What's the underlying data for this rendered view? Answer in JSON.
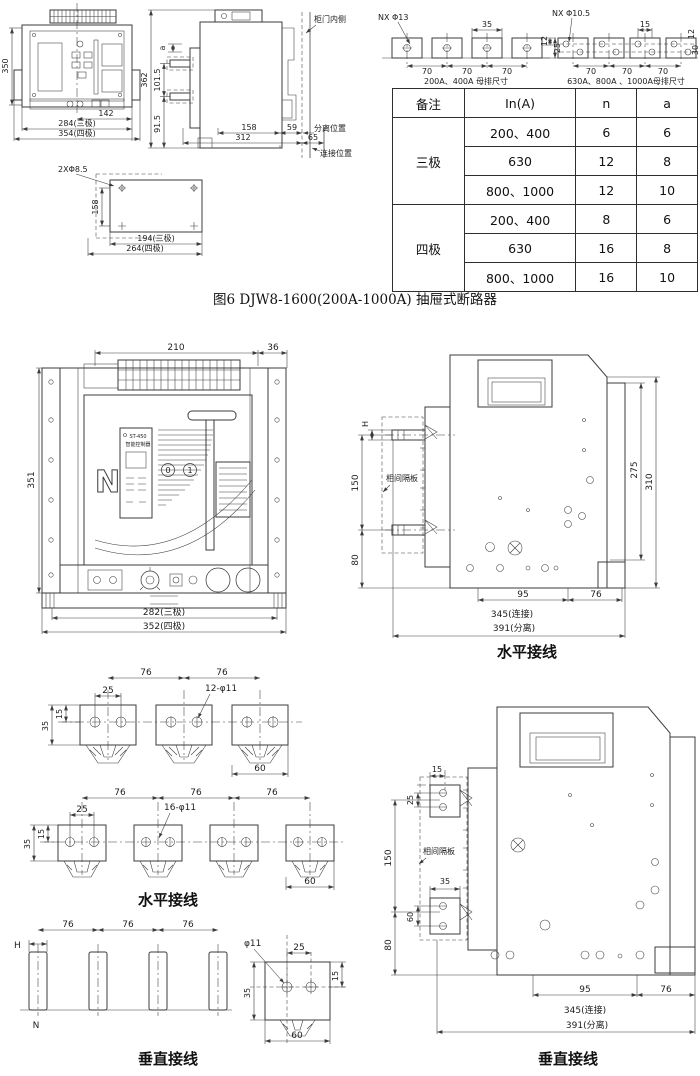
{
  "figure": {
    "caption": "图6  DJW8-1600(200A-1000A) 抽屉式断路器"
  },
  "top_front": {
    "dim_height": "350",
    "dim_142": "142",
    "dim_284": "284(三极)",
    "dim_354": "354(四极)"
  },
  "cutout": {
    "label": "2XΦ8.5",
    "dim_h": "158",
    "dim_194": "194(三极)",
    "dim_264": "264(四极)"
  },
  "top_side": {
    "dim_362": "362",
    "dim_1015": "101.5",
    "dim_915": "91.5",
    "dim_a": "a",
    "dim_158": "158",
    "dim_59": "59",
    "dim_312": "312",
    "dim_65": "65",
    "label_door": "柜门内侧",
    "label_sep": "分离位置",
    "label_conn": "连接位置"
  },
  "busbar_small": {
    "label_holes": "NX Φ13",
    "dim_35": "35",
    "dim_70": "70",
    "dim_12": "12",
    "dim_25": "25",
    "caption": "200A、400A 母排尺寸"
  },
  "busbar_large": {
    "label_holes": "NX Φ10.5",
    "dim_15": "15",
    "dim_70": "70",
    "dim_12": "12",
    "dim_30": "30",
    "caption": "630A、800A 、1000A母排尺寸"
  },
  "spec_table": {
    "headers": [
      "备注",
      "In(A)",
      "n",
      "a"
    ],
    "groups": [
      {
        "label": "三极",
        "rows": [
          [
            "200、400",
            "6",
            "6"
          ],
          [
            "630",
            "12",
            "8"
          ],
          [
            "800、1000",
            "12",
            "10"
          ]
        ]
      },
      {
        "label": "四极",
        "rows": [
          [
            "200、400",
            "8",
            "6"
          ],
          [
            "630",
            "16",
            "8"
          ],
          [
            "800、1000",
            "16",
            "10"
          ]
        ]
      }
    ]
  },
  "mid_front": {
    "dim_210": "210",
    "dim_36": "36",
    "dim_351": "351",
    "dim_282": "282(三极)",
    "dim_352": "352(四极)",
    "controller_name": "ST-450",
    "controller_sub": "智能控制器",
    "n_label": "N",
    "btn_off": "0",
    "btn_on": "1"
  },
  "mid_side": {
    "dim_H": "H",
    "dim_150": "150",
    "dim_80": "80",
    "label_barrier": "相间隔板",
    "dim_275": "275",
    "dim_310": "310",
    "dim_95": "95",
    "dim_76": "76",
    "dim_345": "345(连接)",
    "dim_391": "391(分离)",
    "caption": "水平接线"
  },
  "busbar_3p": {
    "dim_76": "76",
    "dim_25": "25",
    "label_holes": "12-φ11",
    "dim_35": "35",
    "dim_15": "15",
    "dim_60": "60"
  },
  "busbar_4p": {
    "dim_76": "76",
    "dim_25": "25",
    "label_holes": "16-φ11",
    "dim_35": "35",
    "dim_15": "15",
    "dim_60": "60",
    "caption": "水平接线"
  },
  "vert_bars": {
    "dim_H": "H",
    "dim_76": "76",
    "label_n": "N",
    "caption": "垂直接线"
  },
  "pad_detail": {
    "label_hole": "φ11",
    "dim_25": "25",
    "dim_15": "15",
    "dim_35": "35",
    "dim_60": "60"
  },
  "bot_side": {
    "dim_15": "15",
    "dim_25": "25",
    "dim_150": "150",
    "dim_35": "35",
    "dim_60": "60",
    "dim_80": "80",
    "label_barrier": "相间隔板",
    "dim_95": "95",
    "dim_76": "76",
    "dim_345": "345(连接)",
    "dim_391": "391(分离)",
    "caption": "垂直接线"
  }
}
